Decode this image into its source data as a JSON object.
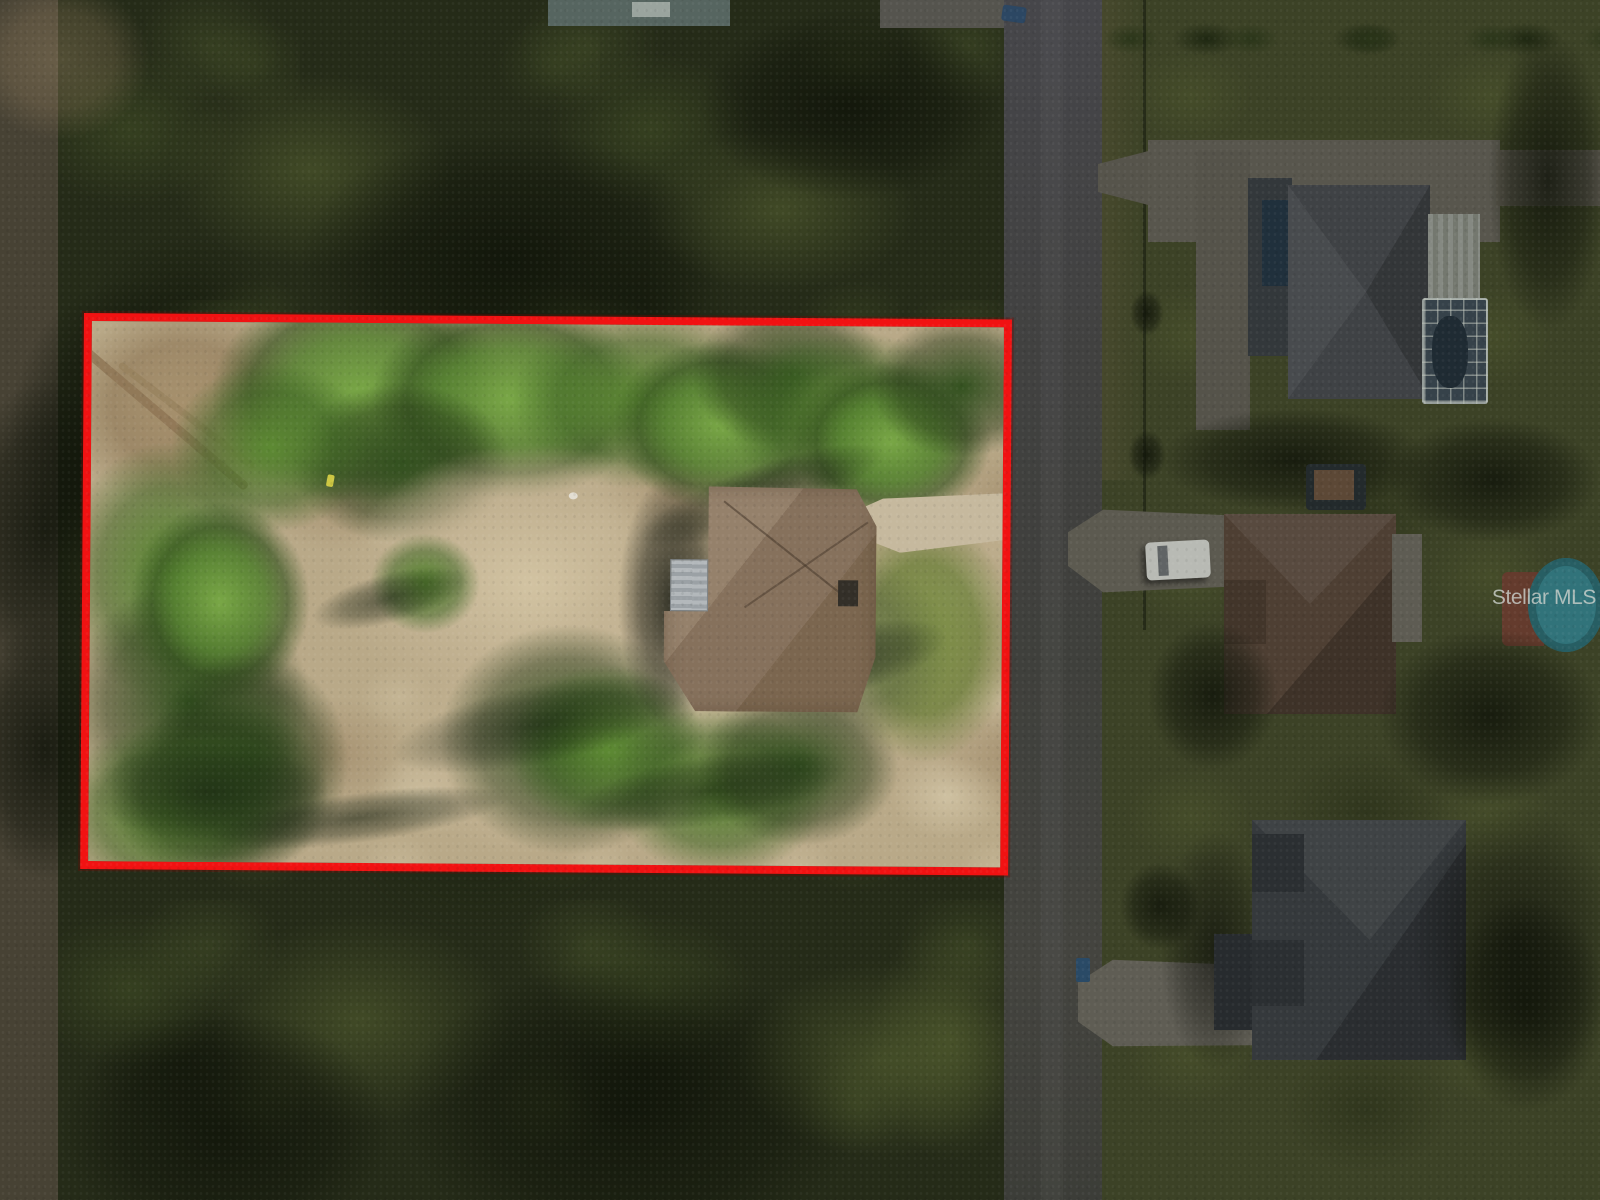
{
  "photo": {
    "watermark": {
      "text": "Stellar MLS",
      "color": "#cad0ca"
    },
    "boundary": {
      "color": "#f11212"
    }
  }
}
